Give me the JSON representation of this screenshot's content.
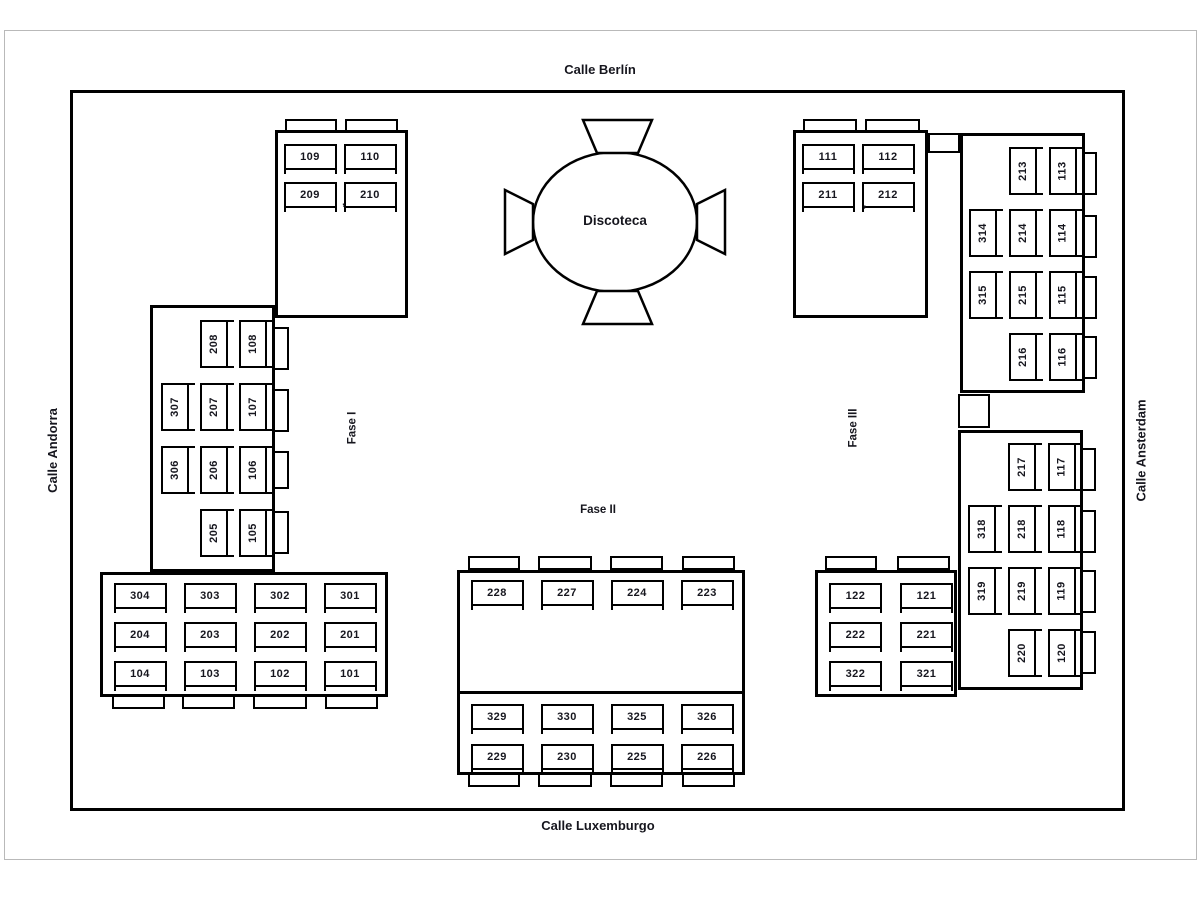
{
  "streets": {
    "top": "Calle Berlín",
    "bottom": "Calle Luxemburgo",
    "left": "Calle Andorra",
    "right": "Calle Ansterdam"
  },
  "venue": {
    "label": "Discoteca"
  },
  "phases": {
    "one": "Fase I",
    "two": "Fase II",
    "three": "Fase III"
  },
  "marks": {
    "left_apostrophe": "’",
    "right_apostrophe": "’"
  },
  "buildings": {
    "top_left": {
      "rows": [
        [
          "109",
          "110"
        ],
        [
          "209",
          "210"
        ]
      ]
    },
    "left_wing": {
      "rows": [
        [
          null,
          "208",
          "108"
        ],
        [
          "307",
          "207",
          "107"
        ],
        [
          "306",
          "206",
          "106"
        ],
        [
          null,
          "205",
          "105"
        ]
      ]
    },
    "bottom_left": {
      "rows": [
        [
          "304",
          "303",
          "302",
          "301"
        ],
        [
          "204",
          "203",
          "202",
          "201"
        ],
        [
          "104",
          "103",
          "102",
          "101"
        ]
      ]
    },
    "center_upper": {
      "rows": [
        [
          "228",
          "227",
          "224",
          "223"
        ]
      ]
    },
    "center_lower": {
      "rows": [
        [
          "329",
          "330",
          "325",
          "326"
        ],
        [
          "229",
          "230",
          "225",
          "226"
        ]
      ]
    },
    "top_right": {
      "rows": [
        [
          "111",
          "112"
        ],
        [
          "211",
          "212"
        ]
      ]
    },
    "right_wing_upper": {
      "rows": [
        [
          null,
          "213",
          "113"
        ],
        [
          "314",
          "214",
          "114"
        ],
        [
          "315",
          "215",
          "115"
        ],
        [
          null,
          "216",
          "116"
        ]
      ]
    },
    "right_wing_lower": {
      "rows": [
        [
          null,
          "217",
          "117"
        ],
        [
          "318",
          "218",
          "118"
        ],
        [
          "319",
          "219",
          "119"
        ],
        [
          null,
          "220",
          "120"
        ]
      ]
    },
    "bottom_right": {
      "rows": [
        [
          "122",
          "121"
        ],
        [
          "222",
          "221"
        ],
        [
          "322",
          "321"
        ]
      ]
    }
  }
}
